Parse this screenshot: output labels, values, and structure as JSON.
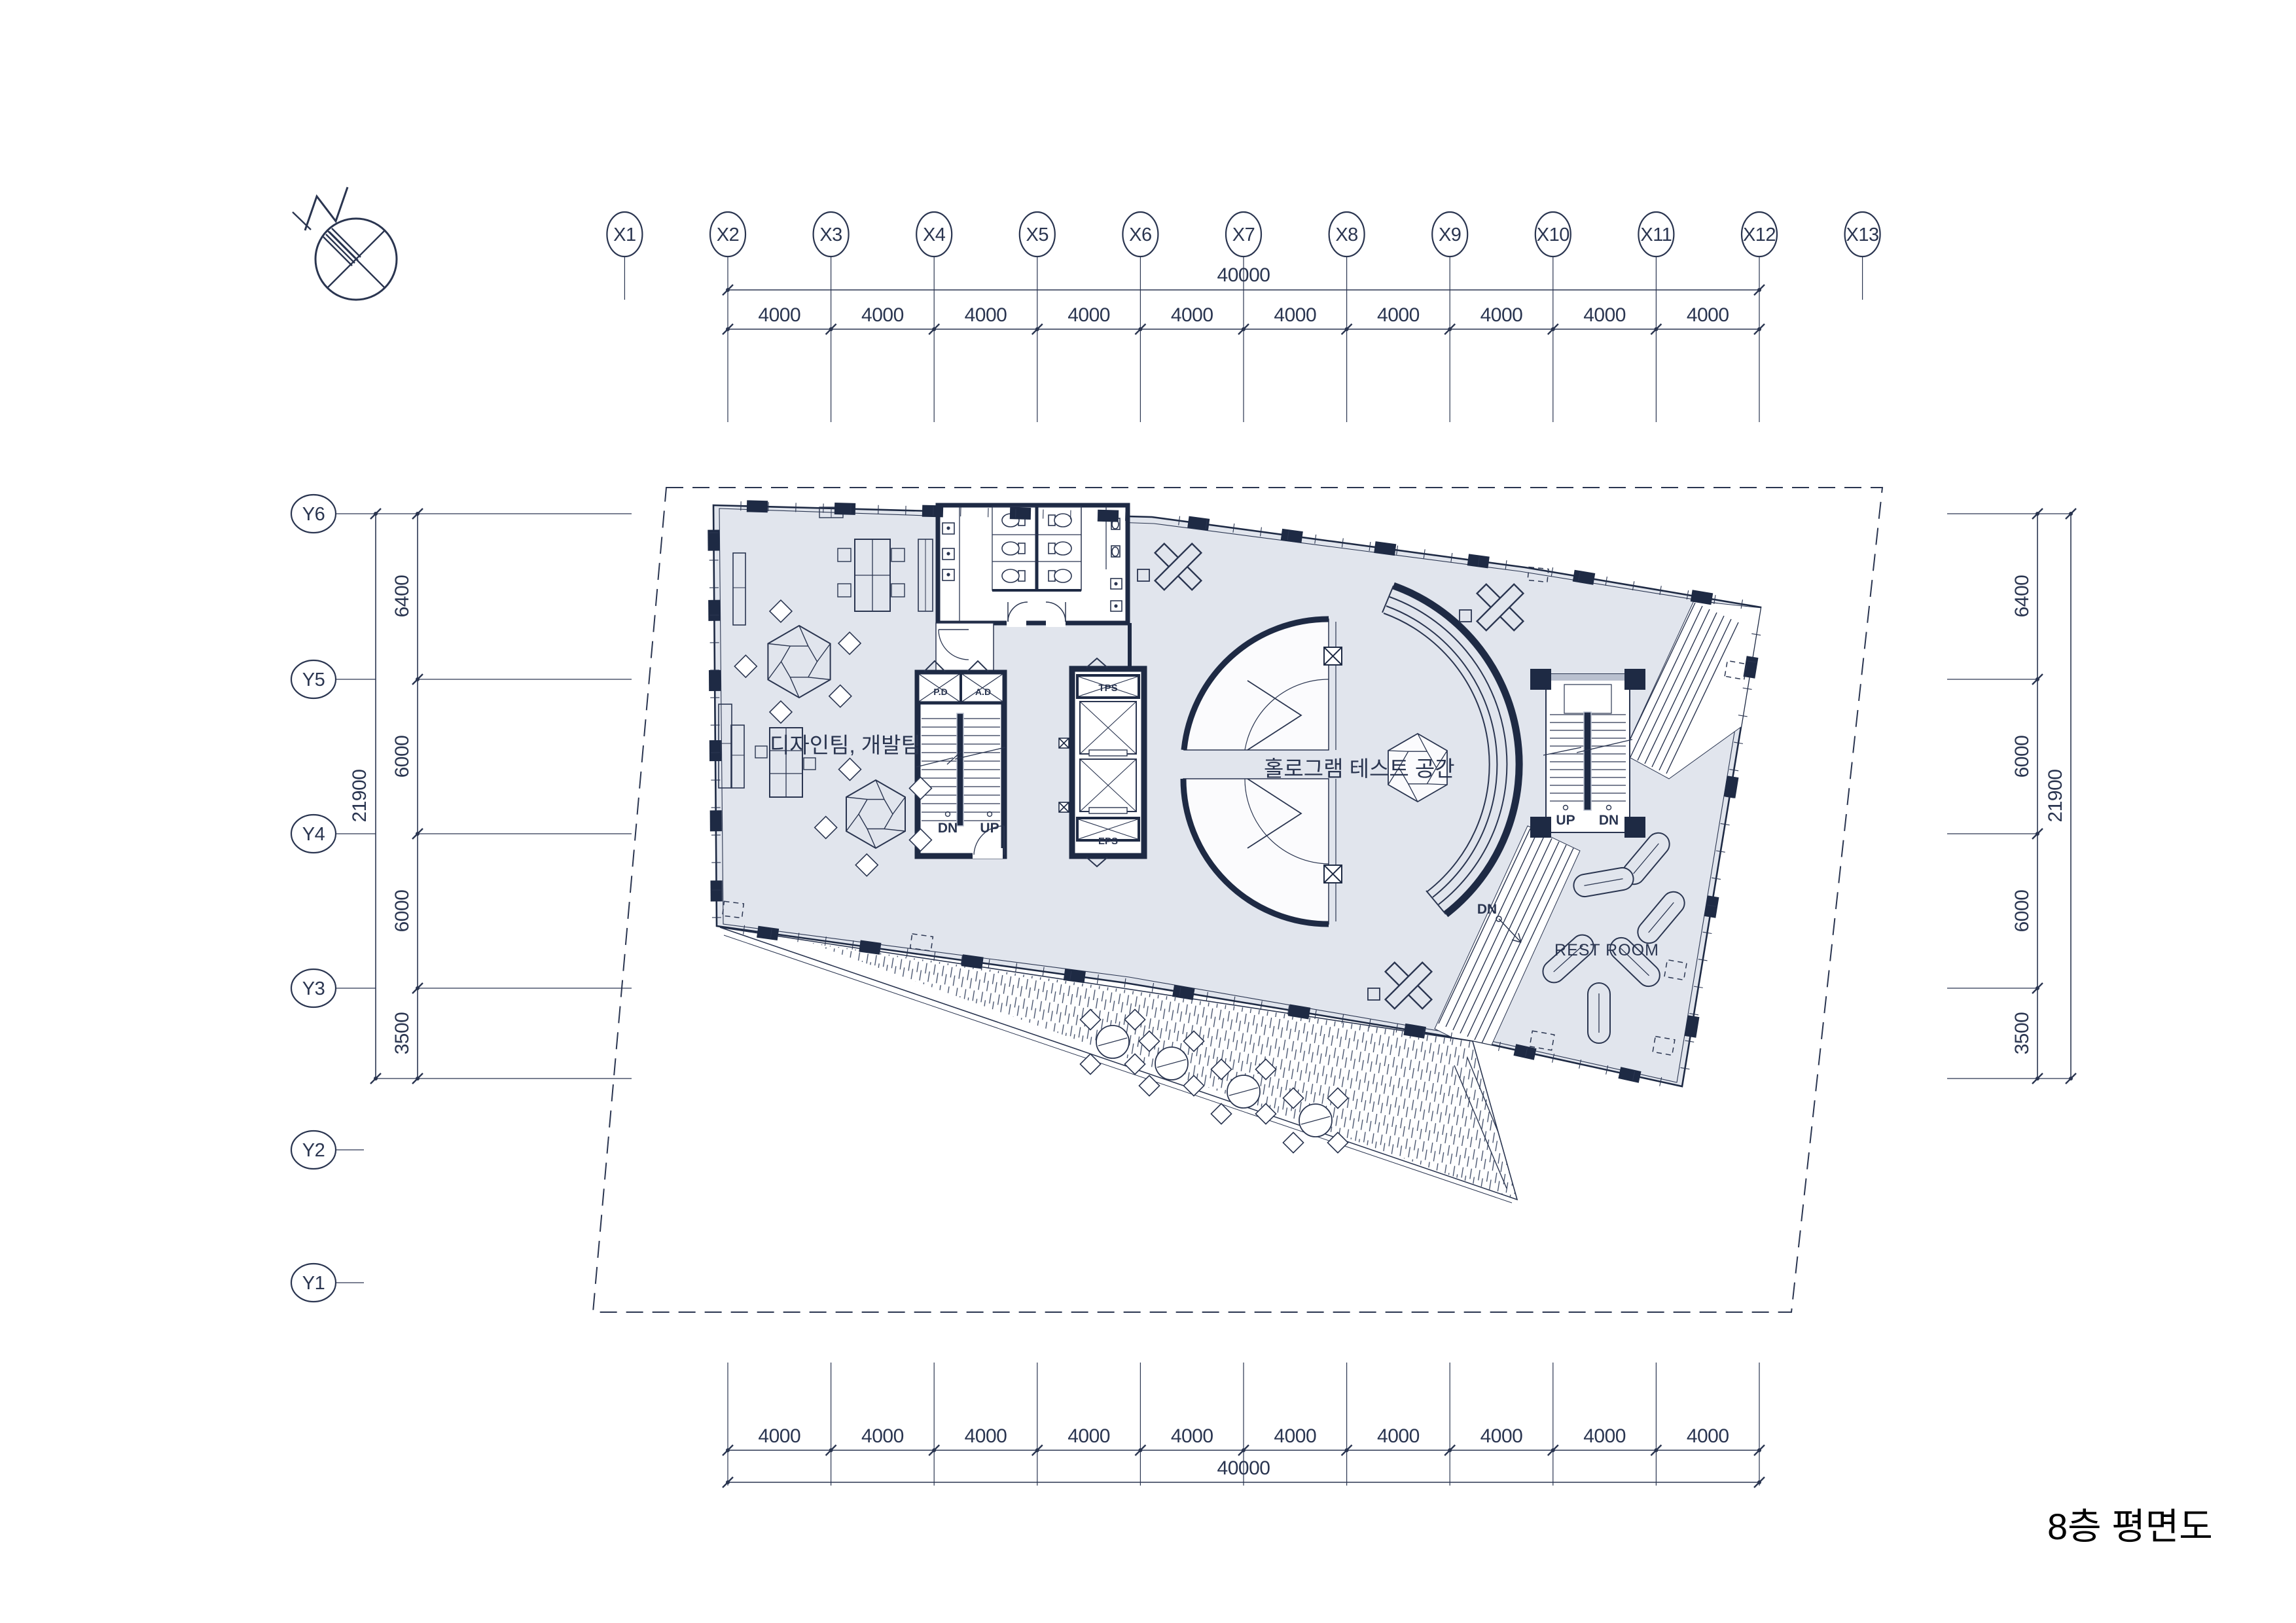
{
  "title": "8층 평면도",
  "grid": {
    "x": [
      "X1",
      "X2",
      "X3",
      "X4",
      "X5",
      "X6",
      "X7",
      "X8",
      "X9",
      "X10",
      "X11",
      "X12",
      "X13"
    ],
    "y": [
      "Y6",
      "Y5",
      "Y4",
      "Y3",
      "Y2",
      "Y1"
    ]
  },
  "dimensions": {
    "top": {
      "segments": [
        "4000",
        "4000",
        "4000",
        "4000",
        "4000",
        "4000",
        "4000",
        "4000",
        "4000",
        "4000"
      ],
      "total": "40000"
    },
    "bottom": {
      "segments": [
        "4000",
        "4000",
        "4000",
        "4000",
        "4000",
        "4000",
        "4000",
        "4000",
        "4000",
        "4000"
      ],
      "total": "40000"
    },
    "left": {
      "segments": [
        "6400",
        "6000",
        "6000",
        "3500"
      ],
      "total": "21900"
    },
    "right": {
      "segments": [
        "6400",
        "6000",
        "6000",
        "3500"
      ],
      "total": "21900"
    }
  },
  "plan": {
    "office_label": "디자인팀, 개발팀",
    "hologram_label": "홀로그램 테스트 공간",
    "restroom_label": "REST ROOM",
    "stair_main": {
      "dn": "DN",
      "up": "UP"
    },
    "stair_east": {
      "up": "UP",
      "dn": "DN"
    },
    "ramp_label": "DN",
    "shafts": {
      "pd": "P.D",
      "ad": "A.D",
      "tps": "TPS",
      "eps": "EPS"
    }
  },
  "colors": {
    "line": "#2a3550",
    "wall": "#1e2a44",
    "floor": "#e1e5ed",
    "paper": "#ffffff",
    "title_text": "#000000",
    "hatch": "#3a4763",
    "rail_gray": "#b9c0cf"
  }
}
